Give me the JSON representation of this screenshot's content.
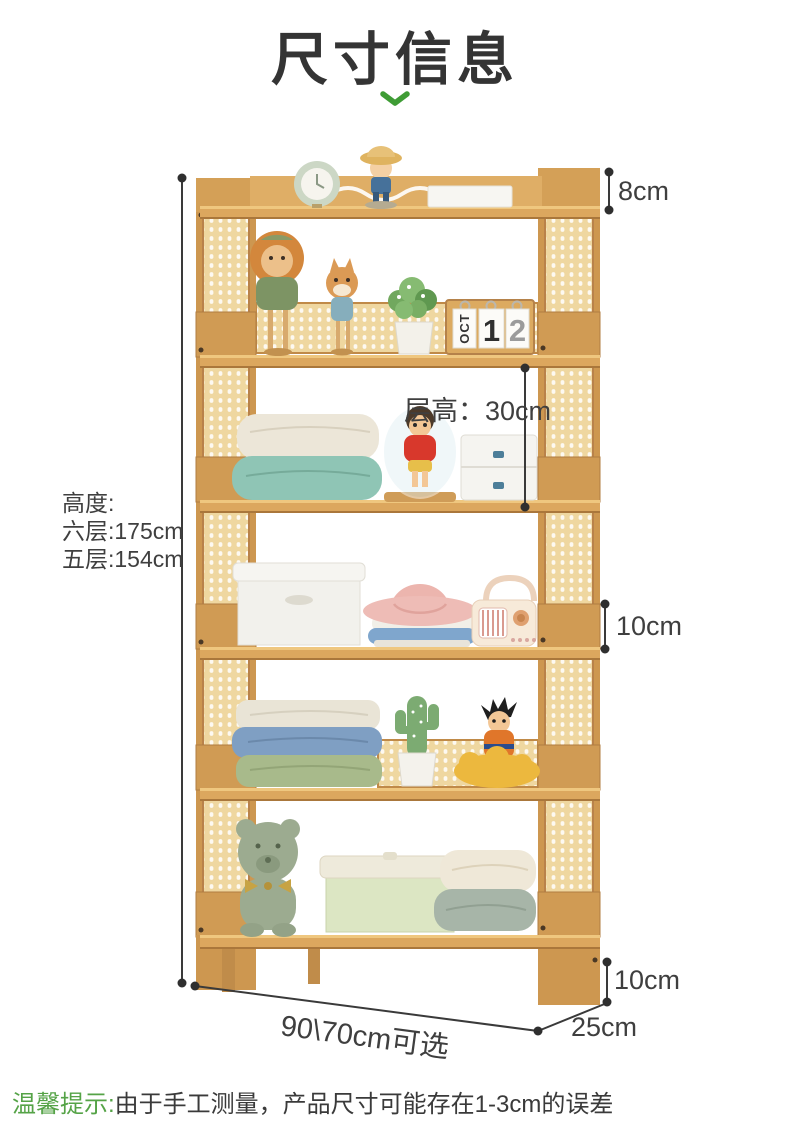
{
  "page": {
    "title": "尺寸信息"
  },
  "annotations": {
    "top_gap": "8cm",
    "tier_height": "层高：30cm",
    "height_title": "高度:",
    "height_six_tier": "六层:175cm",
    "height_five_tier": "五层:154cm",
    "side_rail_height": "10cm",
    "foot_height": "10cm",
    "width_options": "90\\70cm可选",
    "depth": "25cm"
  },
  "calendar": {
    "month": "OCT",
    "day_tens": "1",
    "day_ones": "2"
  },
  "footer": {
    "tip_label": "温馨提示:",
    "tip_text": "由于手工测量，产品尺寸可能存在1-3cm的误差"
  },
  "colors": {
    "accent_green": "#3f9c35",
    "text_dark": "#3f3f3f",
    "wood": "#d09b54",
    "rattan": "#efd7a0",
    "dimension_line": "#3a3a3a"
  }
}
